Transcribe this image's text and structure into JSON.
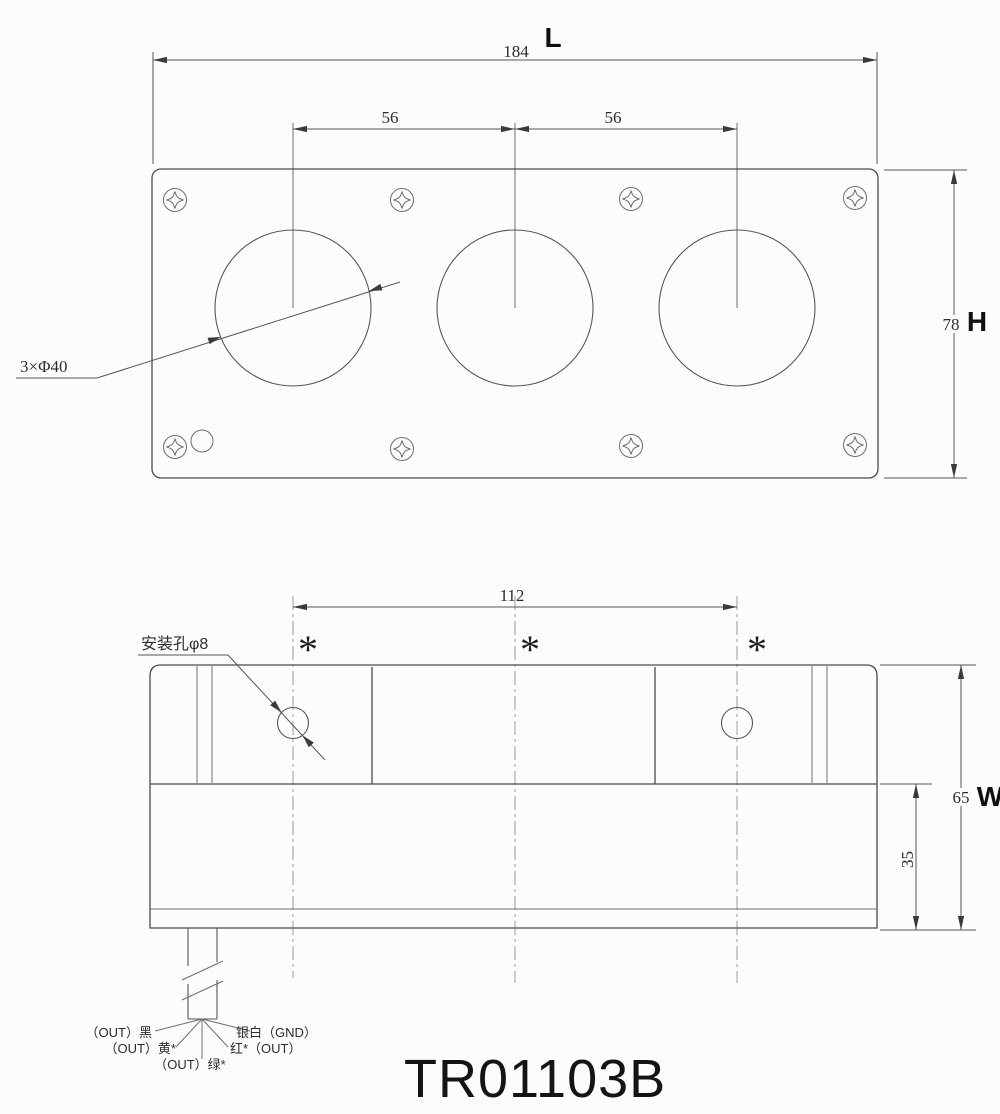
{
  "title": "TR01103B",
  "colors": {
    "line": "#4b4b4b",
    "dim_text": "#2d2d2d",
    "background": "#fcfcfc"
  },
  "top_view": {
    "length_label": "L",
    "length_value": "184",
    "pitch_left_value": "56",
    "pitch_right_value": "56",
    "height_value": "78",
    "height_label": "H",
    "holes_note": "3×Φ40"
  },
  "bottom_view": {
    "span_value": "112",
    "mount_hole_note": "安装孔φ8",
    "marks": [
      "*",
      "*",
      "*"
    ],
    "depth_value": "35",
    "width_value": "65",
    "width_label": "W"
  },
  "wires": {
    "black": "（OUT）黑",
    "yellow": "（OUT）黄*",
    "green": "（OUT）绿*",
    "red": "红*（OUT）",
    "silver": "银白（GND）"
  }
}
